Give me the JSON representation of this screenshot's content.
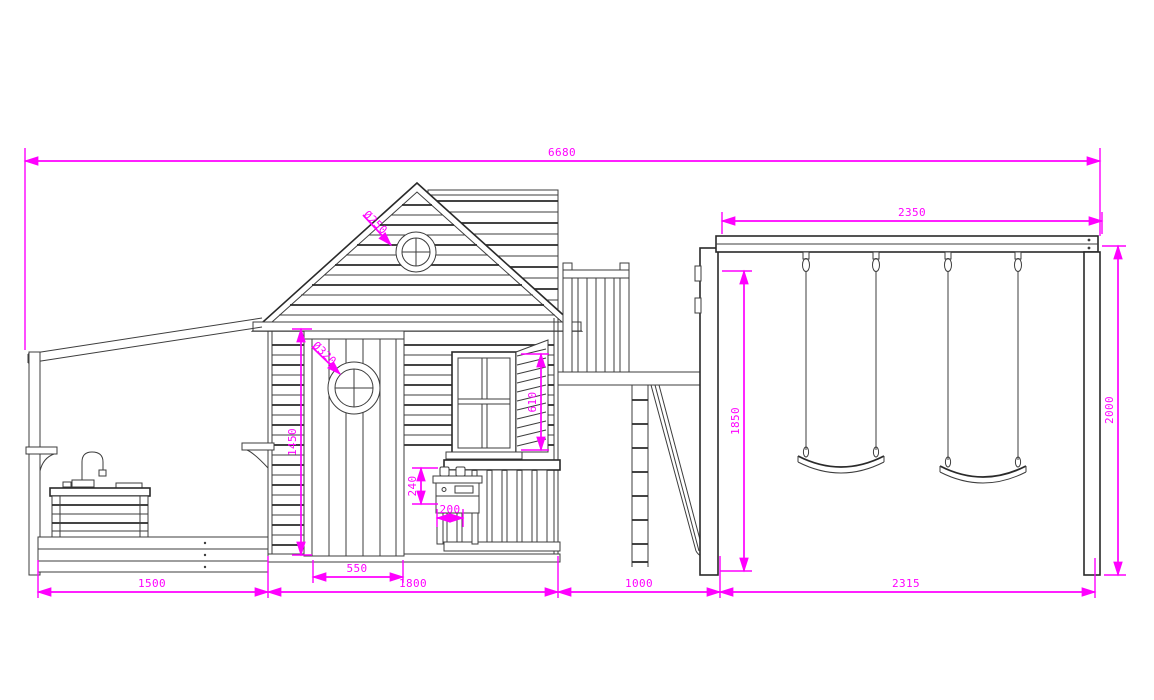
{
  "drawing": {
    "type": "technical-elevation",
    "subject": "Playhouse with porch, mud kitchen, climbing tower, slide and double swing set",
    "units": "mm",
    "colors": {
      "lines": "#3d3d3d",
      "dimensions": "#ff00ff",
      "background": "#ffffff"
    },
    "dims": {
      "overall_width": "6680",
      "beam_length": "2350",
      "frame_height": "2000",
      "post_height": "1850",
      "door_height": "1450",
      "window_height": "610",
      "stove_height": "240",
      "stove_depth": "200",
      "gable_porthole_dia": "Ø250",
      "door_porthole_dia": "Ø320",
      "porch_width": "1500",
      "door_width": "550",
      "house_width": "1800",
      "tower_width": "1000",
      "swing_bay_width": "2315"
    }
  }
}
